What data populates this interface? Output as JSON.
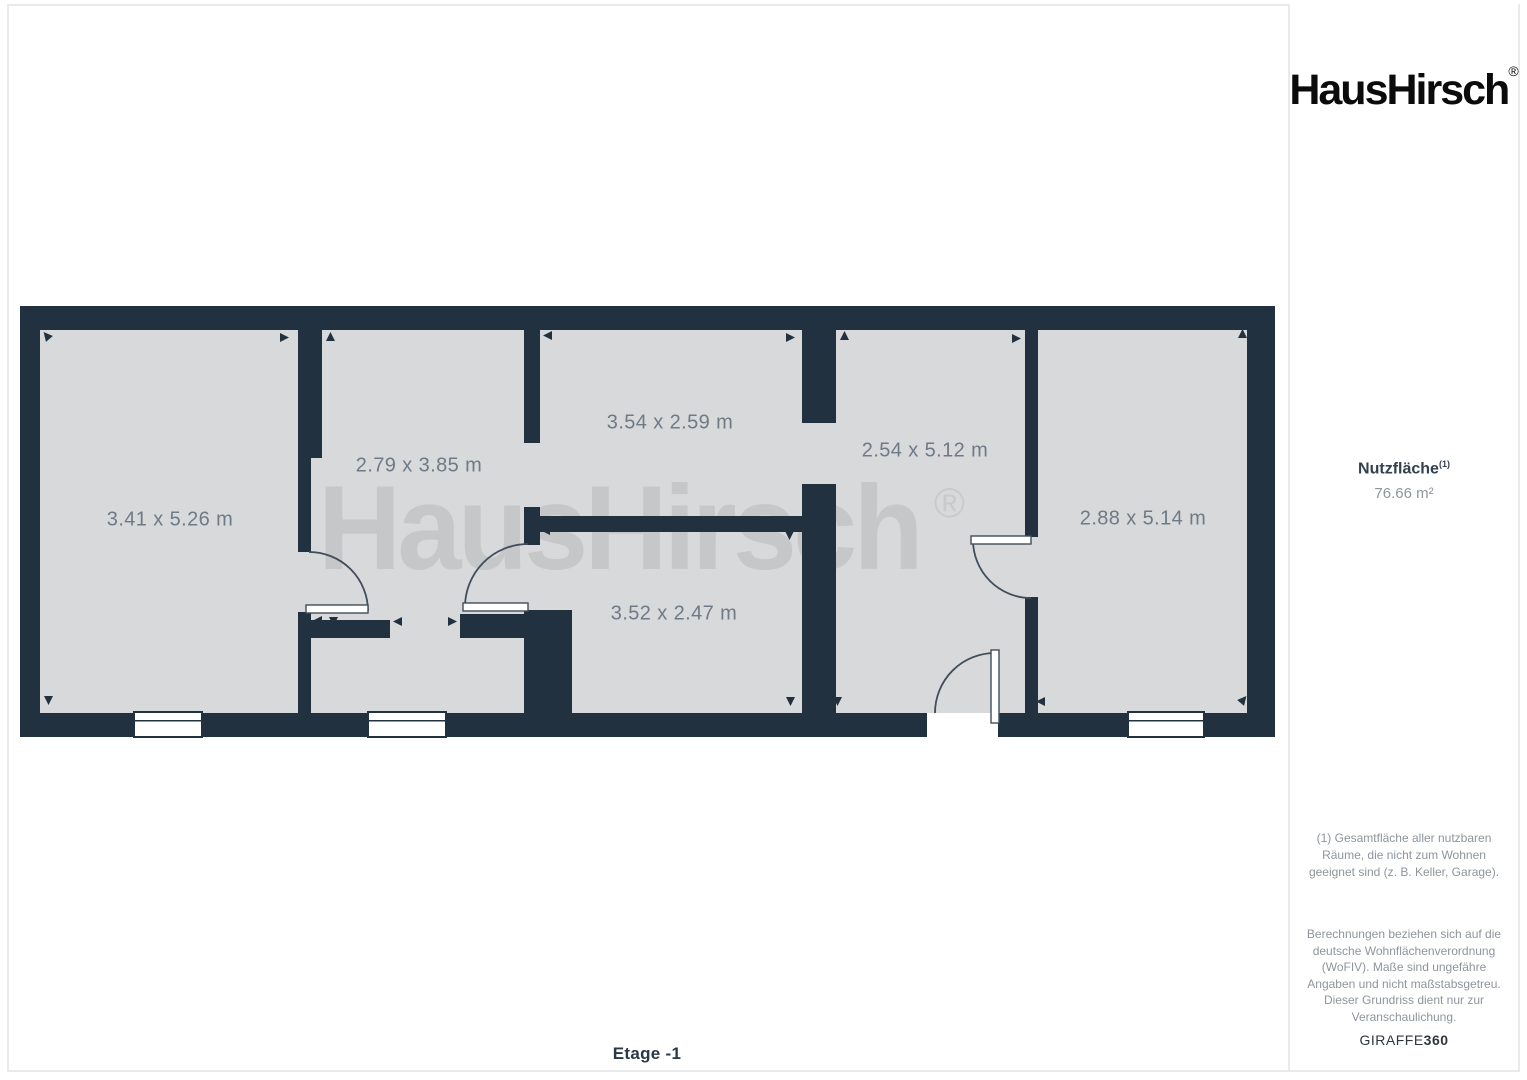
{
  "brand": {
    "logo_text": "HausHirsch",
    "registered_mark": "®"
  },
  "sidebar": {
    "area_label": "Nutzfläche",
    "area_label_superscript": "(1)",
    "area_value": "76.66 m²",
    "footnote": "(1) Gesamtfläche aller nutzbaren Räume, die nicht zum Wohnen geeignet sind (z. B. Keller, Garage).",
    "disclaimer": "Berechnungen beziehen sich auf die deutsche Wohnflächenverordnung (WoFIV). Maße sind ungefähre Angaben und nicht maßstabsgetreu. Dieser Grundriss dient nur zur Veranschaulichung.",
    "provider_regular": "GIRAFFE",
    "provider_bold": "360"
  },
  "floorplan": {
    "floor_label": "Etage -1",
    "watermark_text": "HausHirsch",
    "watermark_mark": "®",
    "rooms": [
      {
        "label": "3.41 x 5.26 m"
      },
      {
        "label": "2.79 x 3.85 m"
      },
      {
        "label": "3.54 x 2.59 m"
      },
      {
        "label": "3.52 x 2.47 m"
      },
      {
        "label": "2.54 x 5.12 m"
      },
      {
        "label": "2.88 x 5.14 m"
      }
    ],
    "colors": {
      "wall": "#223140",
      "room_fill": "#d8d9da",
      "watermark": "#c6c7c9",
      "label": "#6f7a87"
    }
  }
}
